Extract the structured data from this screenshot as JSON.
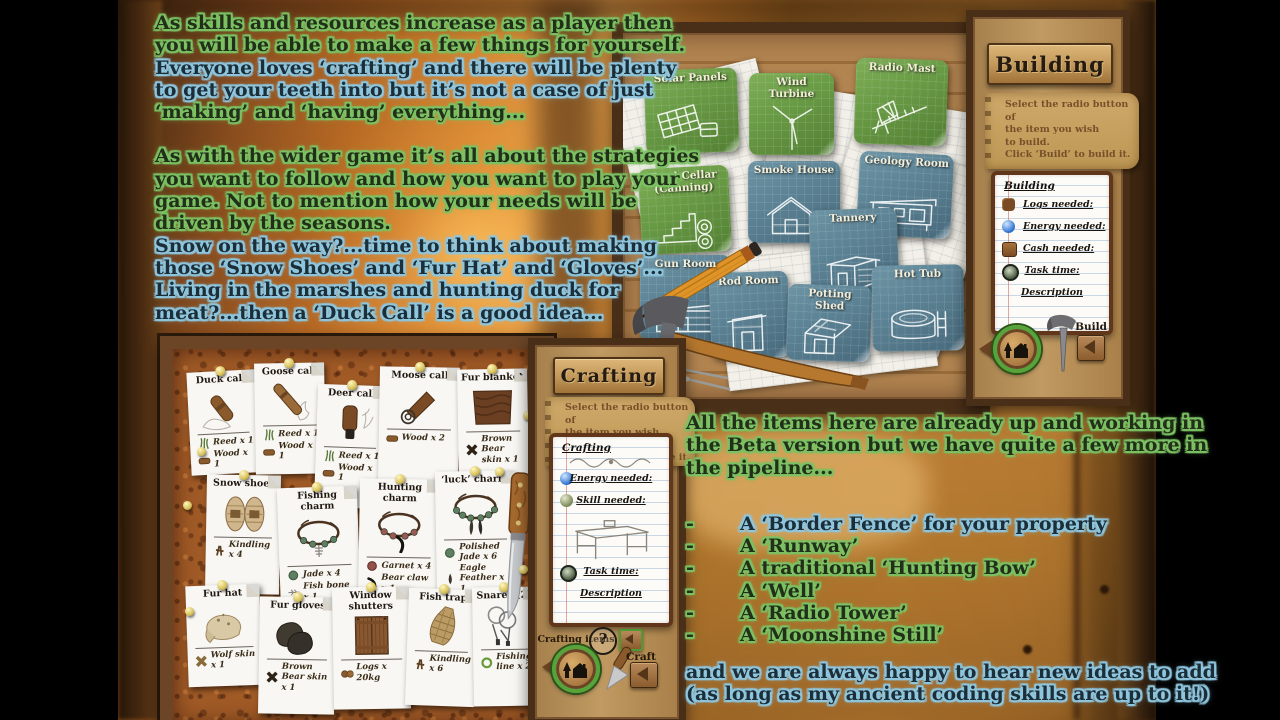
{
  "colors": {
    "glow_green": "#7cc163",
    "glow_blue": "#8fc6de",
    "tile_green": "#6f9d4c",
    "tile_blue": "#5b8294",
    "ring_green": "#57a33b",
    "cork": "#a05a26"
  },
  "intro": {
    "p1": [
      {
        "t": "As skills and resources increase as a player then",
        "g": "g"
      },
      {
        "t": "you will be able to make a few things for yourself.",
        "g": "g"
      },
      {
        "t": "Everyone loves ‘crafting’ and there will be plenty",
        "g": "b"
      },
      {
        "t": "to get your teeth into but it’s not a case of just",
        "g": "b"
      },
      {
        "t": "‘making’ and ‘having’ everything...",
        "g": "g"
      }
    ],
    "p2": [
      {
        "t": "As with the wider game it’s all about the strategies",
        "g": "g"
      },
      {
        "t": "you want to follow and how you want to play your",
        "g": "g"
      },
      {
        "t": "game. Not to mention how your needs will be",
        "g": "g"
      },
      {
        "t": "driven by the seasons.",
        "g": "g"
      },
      {
        "t": "Snow on the way?...time to think about making",
        "g": "b"
      },
      {
        "t": "those ‘Snow Shoes’ and ‘Fur Hat’ and ‘Gloves’...",
        "g": "b"
      },
      {
        "t": "Living in the marshes and hunting duck for",
        "g": "b"
      },
      {
        "t": "meat?...then a ‘Duck Call’ is a good idea...",
        "g": "b"
      }
    ]
  },
  "outro": {
    "p": [
      {
        "t": "All the items here are already up and working in",
        "g": "g"
      },
      {
        "t": "the Beta version but we have quite a few more in",
        "g": "g"
      },
      {
        "t": "the pipeline...",
        "g": "g"
      }
    ],
    "dash": "-",
    "bullets": [
      {
        "t": "A ‘Border Fence’ for your property",
        "g": "b"
      },
      {
        "t": "A ‘Runway’",
        "g": "g"
      },
      {
        "t": "A traditional ‘Hunting Bow’",
        "g": "g"
      },
      {
        "t": "A ‘Well’",
        "g": "g"
      },
      {
        "t": "A ‘Radio Tower’",
        "g": "g"
      },
      {
        "t": "A ‘Moonshine Still’",
        "g": "g"
      }
    ],
    "footer": [
      {
        "t": "and we are always happy to hear new ideas to add",
        "g": "b"
      },
      {
        "t": "(as long as my ancient coding skills are up to it!)",
        "g": "b"
      }
    ]
  },
  "building_window": {
    "title": "Building",
    "instructions": [
      "Select the radio button of",
      "the item you wish",
      "to build.",
      "Click ‘Build’ to build it."
    ],
    "notepad": {
      "header": "Building",
      "rows": [
        {
          "icon": "logs",
          "label": "Logs needed:",
          "center": false
        },
        {
          "icon": "energy",
          "label": "Energy needed:",
          "center": false
        },
        {
          "icon": "cash",
          "label": "Cash needed:",
          "center": false
        },
        {
          "icon": "task",
          "label": "Task time:",
          "center": true
        },
        {
          "icon": "none",
          "label": "Description",
          "center": true
        }
      ]
    },
    "tiles": [
      {
        "label": "Solar Panels",
        "style": "green",
        "art": "solar"
      },
      {
        "label": "Wind Turbine",
        "style": "green",
        "art": "turbine"
      },
      {
        "label": "Radio Mast",
        "style": "green",
        "art": "mast"
      },
      {
        "label": "Food Cellar (Canning)",
        "style": "green",
        "art": "stairs"
      },
      {
        "label": "Smoke House",
        "style": "blue",
        "art": "house"
      },
      {
        "label": "Geology Room",
        "style": "blue",
        "art": "geology"
      },
      {
        "label": "Tannery",
        "style": "blue",
        "art": "tannery"
      },
      {
        "label": "Gun Room",
        "style": "blue",
        "art": "gun"
      },
      {
        "label": "Rod Room",
        "style": "blue",
        "art": "rod"
      },
      {
        "label": "Potting Shed",
        "style": "blue",
        "art": "potting"
      },
      {
        "label": "Hot Tub",
        "style": "blue",
        "art": "hottub"
      }
    ],
    "build_label": "Build"
  },
  "crafting_window": {
    "title": "Crafting",
    "instructions": [
      "Select the radio button of",
      "the item you wish",
      "to craft",
      "Click ‘Craft’ to make it."
    ],
    "notepad": {
      "header": "Crafting",
      "rows_top": [
        {
          "icon": "energy",
          "label": "Energy needed:",
          "center": true
        },
        {
          "icon": "skill",
          "label": "Skill needed:",
          "center": true
        }
      ],
      "rows_bottom": [
        {
          "icon": "task",
          "label": "Task time:",
          "center": true
        },
        {
          "icon": "none",
          "label": "Description",
          "center": true
        }
      ]
    },
    "cards": [
      {
        "title": "Duck call",
        "art": "duck",
        "ingredients": [
          {
            "icon": "reed",
            "text": "Reed x 1"
          },
          {
            "icon": "wood",
            "text": "Wood x 1"
          }
        ]
      },
      {
        "title": "Goose call",
        "art": "goose",
        "ingredients": [
          {
            "icon": "reed",
            "text": "Reed x 1"
          },
          {
            "icon": "wood",
            "text": "Wood x 1"
          }
        ]
      },
      {
        "title": "Deer call",
        "art": "deer",
        "ingredients": [
          {
            "icon": "reed",
            "text": "Reed x 1"
          },
          {
            "icon": "wood",
            "text": "Wood x 1"
          }
        ]
      },
      {
        "title": "Moose call",
        "art": "moose",
        "ingredients": [
          {
            "icon": "wood",
            "text": "Wood x 2"
          }
        ]
      },
      {
        "title": "Fur blanket",
        "art": "blanket",
        "ingredients": [
          {
            "icon": "pelt",
            "text": "Brown Bear skin x 1"
          }
        ]
      },
      {
        "title": "Snow shoes",
        "art": "snowshoes",
        "ingredients": [
          {
            "icon": "kindling",
            "text": "Kindling x 4"
          }
        ]
      },
      {
        "title": "Fishing charm",
        "art": "charm-fishing",
        "ingredients": [
          {
            "icon": "jade",
            "text": "Jade x 4"
          },
          {
            "icon": "fishbone",
            "text": "Fish bone x 1"
          }
        ]
      },
      {
        "title": "Hunting charm",
        "art": "charm-hunting",
        "ingredients": [
          {
            "icon": "garnet",
            "text": "Garnet x 4"
          },
          {
            "icon": "bearclaw",
            "text": "Bear claw x 1"
          }
        ]
      },
      {
        "title": "‘luck’ charm",
        "art": "charm-luck",
        "ingredients": [
          {
            "icon": "jade",
            "text": "Polished Jade x 6"
          },
          {
            "icon": "feather",
            "text": "Eagle Feather x 1"
          }
        ]
      },
      {
        "title": "Fur hat",
        "art": "furhat",
        "ingredients": [
          {
            "icon": "pelt-tan",
            "text": "Wolf skin x 1"
          }
        ]
      },
      {
        "title": "Fur gloves",
        "art": "gloves",
        "ingredients": [
          {
            "icon": "pelt",
            "text": "Brown Bear skin x 1"
          }
        ]
      },
      {
        "title": "Window shutters",
        "art": "shutters",
        "ingredients": [
          {
            "icon": "logs",
            "text": "Logs x 20kg"
          }
        ]
      },
      {
        "title": "Fish trap",
        "art": "trap",
        "ingredients": [
          {
            "icon": "kindling",
            "text": "Kindling x 6"
          }
        ]
      },
      {
        "title": "Snares (2)",
        "art": "snares",
        "ingredients": [
          {
            "icon": "line",
            "text": "Fishing line x 2"
          }
        ]
      }
    ],
    "crafting_items_label": "Crafting items",
    "help_label": "?",
    "craft_label": "Craft"
  }
}
